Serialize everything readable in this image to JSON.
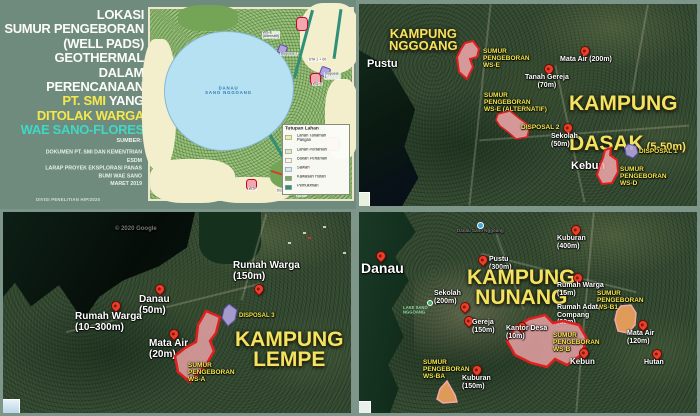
{
  "colors": {
    "frame_green": "#7e9689",
    "panel_green": "#6f8b7d",
    "accent_yellow": "#f6e84c",
    "title_turquoise": "#3fd8c5",
    "village_yellow": "#f2e360",
    "label_white": "#ffffff",
    "pin_red": "#e8402a",
    "polygon_pink": "#f2a8ab",
    "polygon_red": "#e01f1f",
    "polygon_purple": "#b0a4dc",
    "polygon_purple_stroke": "#5b4fae",
    "polygon_orange": "#f2a45c",
    "lake_blue": "#b5e1f3"
  },
  "title_panel": {
    "l1": "LOKASI",
    "l2": "SUMUR PENGEBORAN",
    "l3": "(WELL PADS)",
    "l4": "GEOTHERMAL",
    "l5": "DALAM",
    "l6": "PERENCANAAN",
    "l7a": "PT. SMI",
    "l7b": " YANG",
    "l8": "DITOLAK WARGA",
    "l9": "WAE SANO-FLORES",
    "source_label": "SUMBER:",
    "source_1": "DOKUMEN PT. SMI DAN KEMENTRIAN ESDM",
    "source_2": "LARAP PROYEK EKSPLORASI PANAS BUMI WAE SANO",
    "source_3": "MARET 2019",
    "credit": "DIVISI PENELITIAN HIP/2020"
  },
  "landuse_map": {
    "lake_label": "DANAU\nSANO NGGOANG",
    "legend_title": "Tutupan Lahan",
    "legend": [
      {
        "label": "Lahan Tanaman\nPangan",
        "color": "#f2eda0"
      },
      {
        "label": "Lahan Pertanian",
        "color": "#d9eec3"
      },
      {
        "label": "Bukan Pertanian",
        "color": "#faf6e8"
      },
      {
        "label": "Sawah",
        "color": "#cfe9f6"
      },
      {
        "label": "Kawasan Hutan",
        "color": "#79a95c"
      },
      {
        "label": "Pemukiman",
        "color": "#2f8f78"
      }
    ],
    "ann": {
      "ws_e_alt": "WS-E\n(Alternatif)",
      "disposal_2": "Disposal 2",
      "sta": "STA 1 + 00",
      "disposal_1": "Disposal 1",
      "ws_d": "WS-D",
      "ws_b": "WS-B",
      "wtp": "WTP",
      "disposal_3": "Disposal 3",
      "ws_a": "WS-A"
    }
  },
  "map_dasak": {
    "kampung_nggoang": "KAMPUNG\nNGGOANG",
    "pustu": "Pustu",
    "ws_e": "SUMUR\nPENGEBORAN\nWS-E",
    "mata_air": "Mata Air (200m)",
    "tanah_gereja": "Tanah Gereja\n(70m)",
    "kampung_line1": "KAMPUNG",
    "kampung_line2": "DASAK",
    "kampung_dist": "(5-50m)",
    "ws_e_alt": "SUMUR\nPENGEBORAN\nWS-E (ALTERNATIF)",
    "disposal_2": "DISPOSAL 2",
    "sekolah": "Sekolah\n(50m)",
    "disposal_1": "DISPOSAL 1",
    "kebun": "Kebun",
    "ws_d": "SUMUR\nPENGEBORAN\nWS-D"
  },
  "map_lempe": {
    "watermark": "© 2020 Google",
    "rumah_warga_150": "Rumah Warga\n(150m)",
    "danau": "Danau\n(50m)",
    "rumah_warga_10_300": "Rumah Warga\n(10–300m)",
    "mata_air": "Mata Air\n(20m)",
    "disposal_3": "DISPOSAL 3",
    "kampung": "KAMPUNG\nLEMPE",
    "ws_a": "SUMUR\nPENGEBORAN\nWS-A"
  },
  "map_nunang": {
    "danau": "Danau",
    "danau_sano": "Danau Sano Nggoang",
    "kuburan_400": "Kuburan\n(400m)",
    "pustu": "Pustu\n(300m)",
    "kampung": "KAMPUNG\nNUNANG",
    "rumah_warga": "Rumah Warga\n(15m)",
    "sekolah": "Sekolah\n(200m)",
    "ws_b1": "SUMUR\nPENGEBORAN\nWS-B1",
    "rumah_adat": "Rumah Adat,\nCompang\n(30m)",
    "mata_air": "Mata Air\n(120m)",
    "gereja": "Gereja\n(150m)",
    "kantor_desa": "Kantor Desa\n(10m)",
    "ws_b": "SUMUR\nPENGEBORAN\nWS-B",
    "kebun": "Kebun",
    "hutan": "Hutan",
    "ws_ba": "SUMUR\nPENGEBORAN\nWS-BA",
    "kuburan_150": "Kuburan\n(150m)",
    "lake_label": "LAKE SANO\nNGGOANG"
  }
}
